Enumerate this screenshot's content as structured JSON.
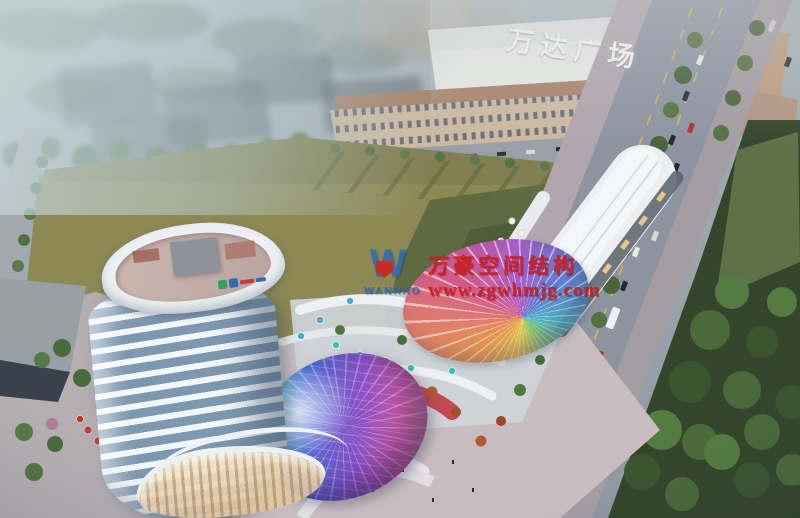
{
  "scene": {
    "kind": "aerial-architectural-rendering",
    "mall_sign": "万达广场"
  },
  "watermark": {
    "company_cn": "万豪空间结构",
    "website": "www.zgwhmjg.com",
    "logo_text": "WANHAO",
    "logo_monogram": "W",
    "text_color": "#cf1d1a",
    "logo_color": "#2f6cb3",
    "badge_color": "#c9241e"
  },
  "palette": {
    "haze": "#bccbce",
    "field_green": "#8d8955",
    "field_shadow": "#57623e",
    "road_gray": "#8d94a0",
    "lane_yellow": "#d8b84a",
    "tree_green": "#4e6a3f",
    "tower_white": "#f4f7f9",
    "tower_glass": "#7e98b2",
    "mall_white": "#e7e9e6",
    "mall_facade_tan": "#cdb9a2",
    "dome_iridescent": [
      "#35b8cc",
      "#4a6ad0",
      "#8a50c8",
      "#cf58a2"
    ],
    "membrane_rainbow": [
      "#e8c84a",
      "#e8964a",
      "#d85a88",
      "#a85ac8",
      "#5a78d0",
      "#4ab8c8"
    ],
    "accent_red_facade": "#c23a44",
    "umbrella_blue": "#4aa8cc"
  }
}
